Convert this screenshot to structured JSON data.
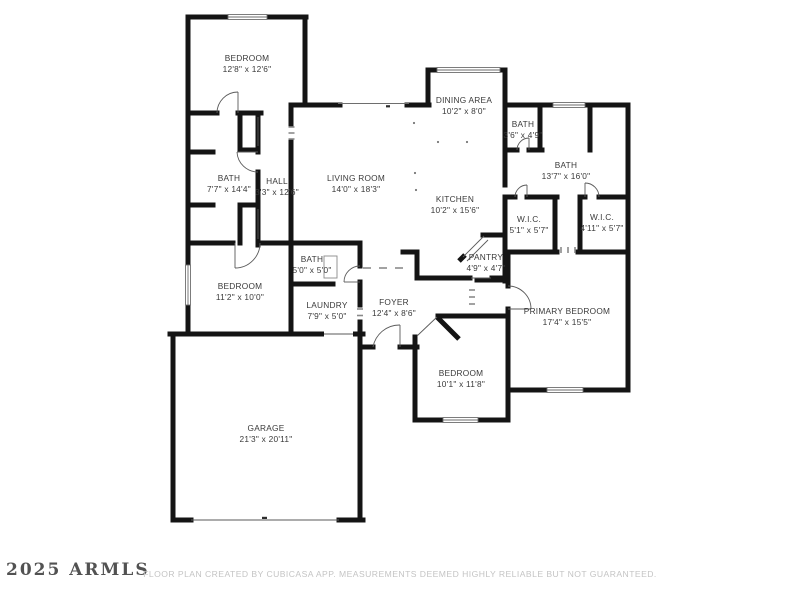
{
  "footer": {
    "watermark": "2025 ARMLS",
    "disclaimer": "FLOOR PLAN CREATED BY CUBICASA APP. MEASUREMENTS DEEMED HIGHLY RELIABLE BUT NOT GUARANTEED."
  },
  "colors": {
    "wall": "#141414",
    "label_text": "#3a3a3a",
    "window_outline": "#6e6e6e",
    "opening_dash": "#8a8a8a",
    "disclaimer_text": "#c4c4c4",
    "background": "#ffffff"
  },
  "rooms": {
    "bedroom_top_left": {
      "name": "BEDROOM",
      "dims": "12'8\" x 12'6\""
    },
    "dining": {
      "name": "DINING AREA",
      "dims": "10'2\" x 8'0\""
    },
    "bath_top": {
      "name": "BATH",
      "dims": "3'6\" x 4'9\""
    },
    "bath_right": {
      "name": "BATH",
      "dims": "13'7\" x 16'0\""
    },
    "living": {
      "name": "LIVING ROOM",
      "dims": "14'0\" x 18'3\""
    },
    "bath_left": {
      "name": "BATH",
      "dims": "7'7\" x 14'4\""
    },
    "hall": {
      "name": "HALL",
      "dims": "3'3\" x 12'6\""
    },
    "kitchen": {
      "name": "KITCHEN",
      "dims": "10'2\" x 15'6\""
    },
    "wic_left": {
      "name": "W.I.C.",
      "dims": "5'1\" x 5'7\""
    },
    "wic_right": {
      "name": "W.I.C.",
      "dims": "4'11\" x 5'7\""
    },
    "pantry": {
      "name": "PANTRY",
      "dims": "4'9\" x 4'7\""
    },
    "bath_center": {
      "name": "BATH",
      "dims": "5'0\" x 5'0\""
    },
    "bedroom_left": {
      "name": "BEDROOM",
      "dims": "11'2\" x 10'0\""
    },
    "laundry": {
      "name": "LAUNDRY",
      "dims": "7'9\" x 5'0\""
    },
    "foyer": {
      "name": "FOYER",
      "dims": "12'4\" x 8'6\""
    },
    "primary_bedroom": {
      "name": "PRIMARY BEDROOM",
      "dims": "17'4\" x 15'5\""
    },
    "bedroom_bottom": {
      "name": "BEDROOM",
      "dims": "10'1\" x 11'8\""
    },
    "garage": {
      "name": "GARAGE",
      "dims": "21'3\" x 20'11\""
    }
  }
}
